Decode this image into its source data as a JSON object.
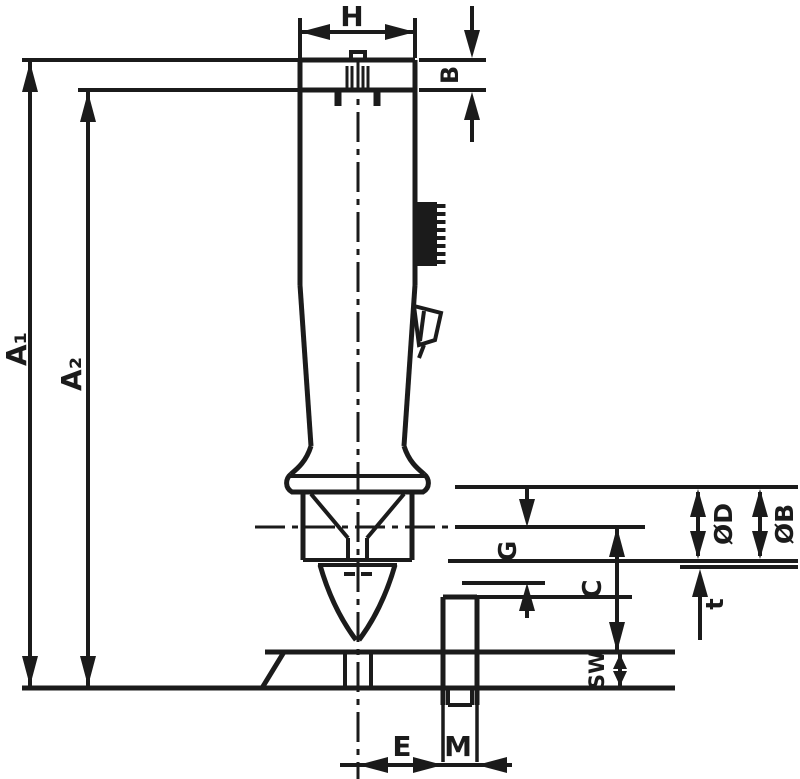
{
  "drawing": {
    "type": "technical-dimension-drawing",
    "subject": "sampling-valve-side-view",
    "line_color": "#1b1b1b",
    "background": "#ffffff",
    "labels": {
      "h": "H",
      "b": "B",
      "a1": "A₁",
      "a2": "A₂",
      "g": "G",
      "c": "C",
      "sw": "SW",
      "t": "t",
      "dia_d": "ØD",
      "dia_b": "ØB",
      "e": "E",
      "m": "M"
    }
  }
}
